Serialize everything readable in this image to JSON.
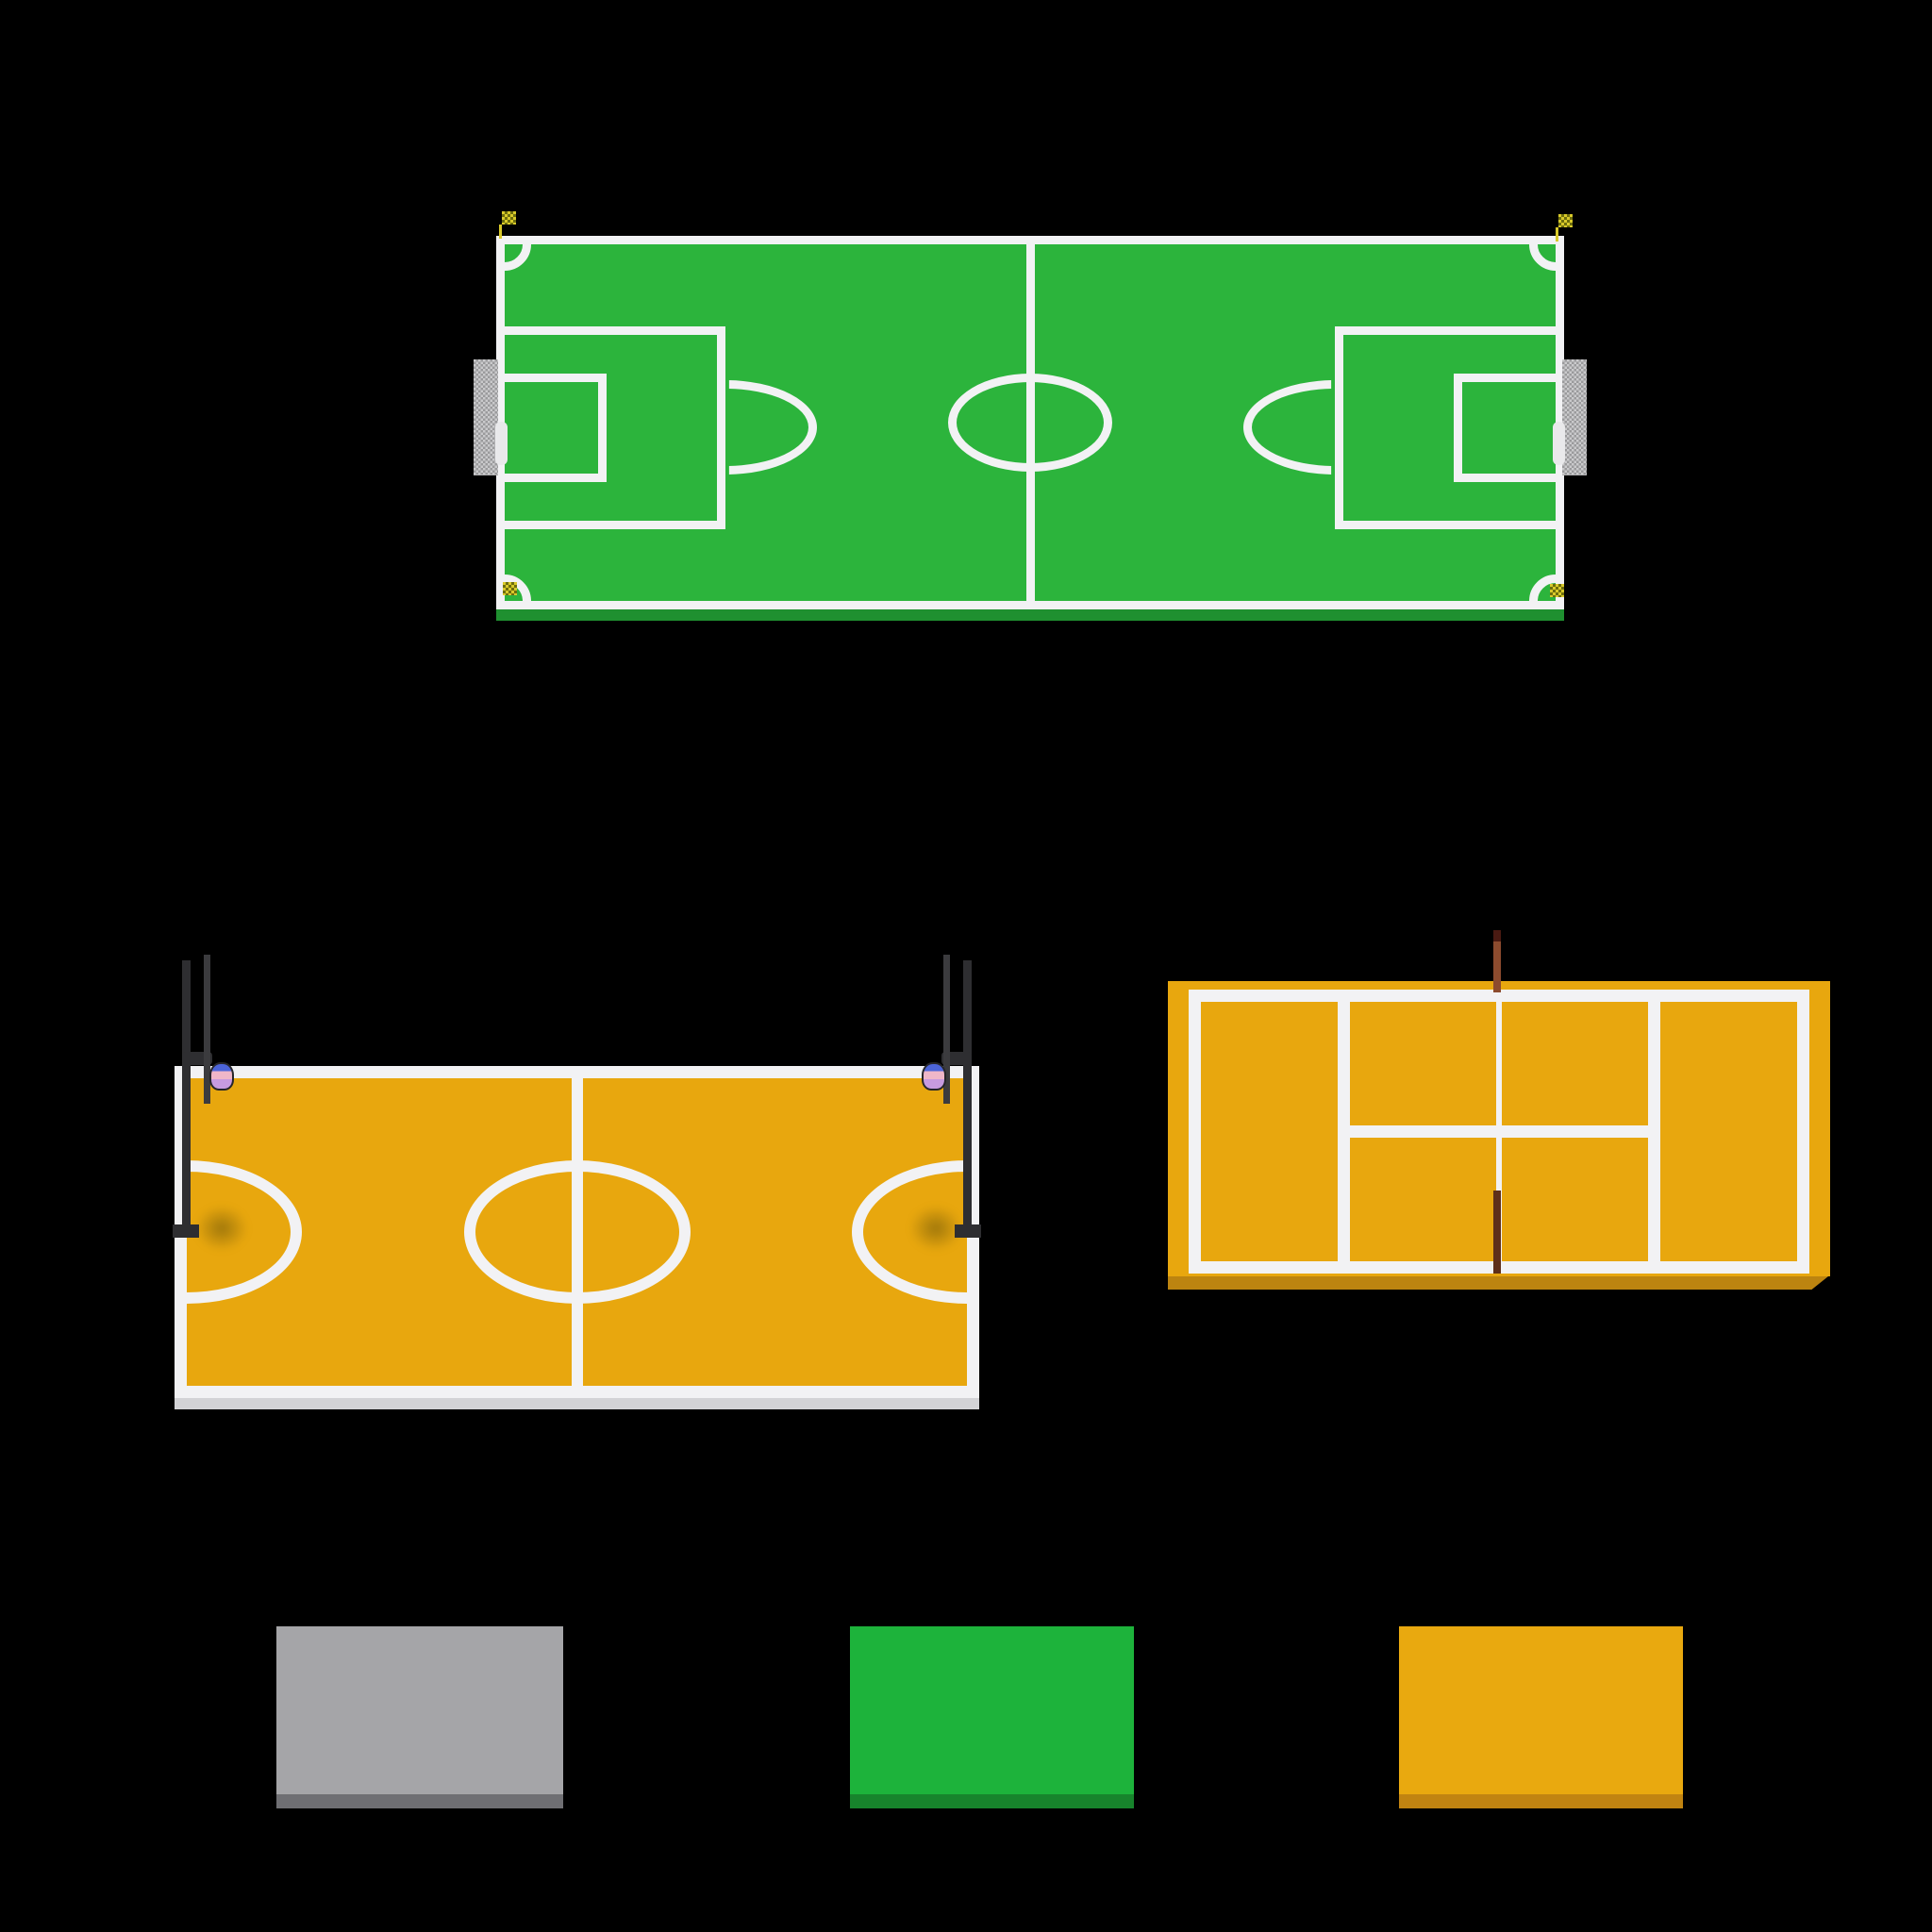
{
  "colors": {
    "background": "#000000",
    "line_white": "#F2F2F4",
    "grass_green": "#2CB43C",
    "grass_side": "#1F9030",
    "court_orange": "#E8A70E",
    "bb_side": "#D3D3D6",
    "tennis_side": "#BC8410",
    "tennis_bevel": "#D89B13",
    "goal_net_gray": "#CACACC",
    "net_dot": "#9A9A9C",
    "goal_bar": "#E9E9EB",
    "flag_yellow": "#D8C92A",
    "flag_dark": "#6E6E0E",
    "pole_dark": "#2E2E31",
    "backboard_dark": "#3B3B3E",
    "net_blue": "#4C64D8",
    "net_pink": "#EFB6C8",
    "net_violet": "#C79BE0",
    "post_brown": "#8C4B2E",
    "post_tip": "#4A1A12",
    "rod_brown": "#5E2F1A",
    "shadow_olive": "rgba(100,80,10,0.55)"
  },
  "objects": {
    "soccer_field": {
      "surface_color": "#2CB43C",
      "line_color": "#F2F2F4"
    },
    "basketball_court": {
      "surface_color": "#E8A70E",
      "line_color": "#F2F2F4"
    },
    "tennis_court": {
      "surface_color": "#E8A70E",
      "line_color": "#F2F2F4"
    }
  },
  "swatches": [
    {
      "name": "gray-slab",
      "top": "#A5A5A8",
      "side": "#6F6F73"
    },
    {
      "name": "green-slab",
      "top": "#1DB33B",
      "side": "#17842C"
    },
    {
      "name": "orange-slab",
      "top": "#E9A90F",
      "side": "#C18411"
    }
  ]
}
